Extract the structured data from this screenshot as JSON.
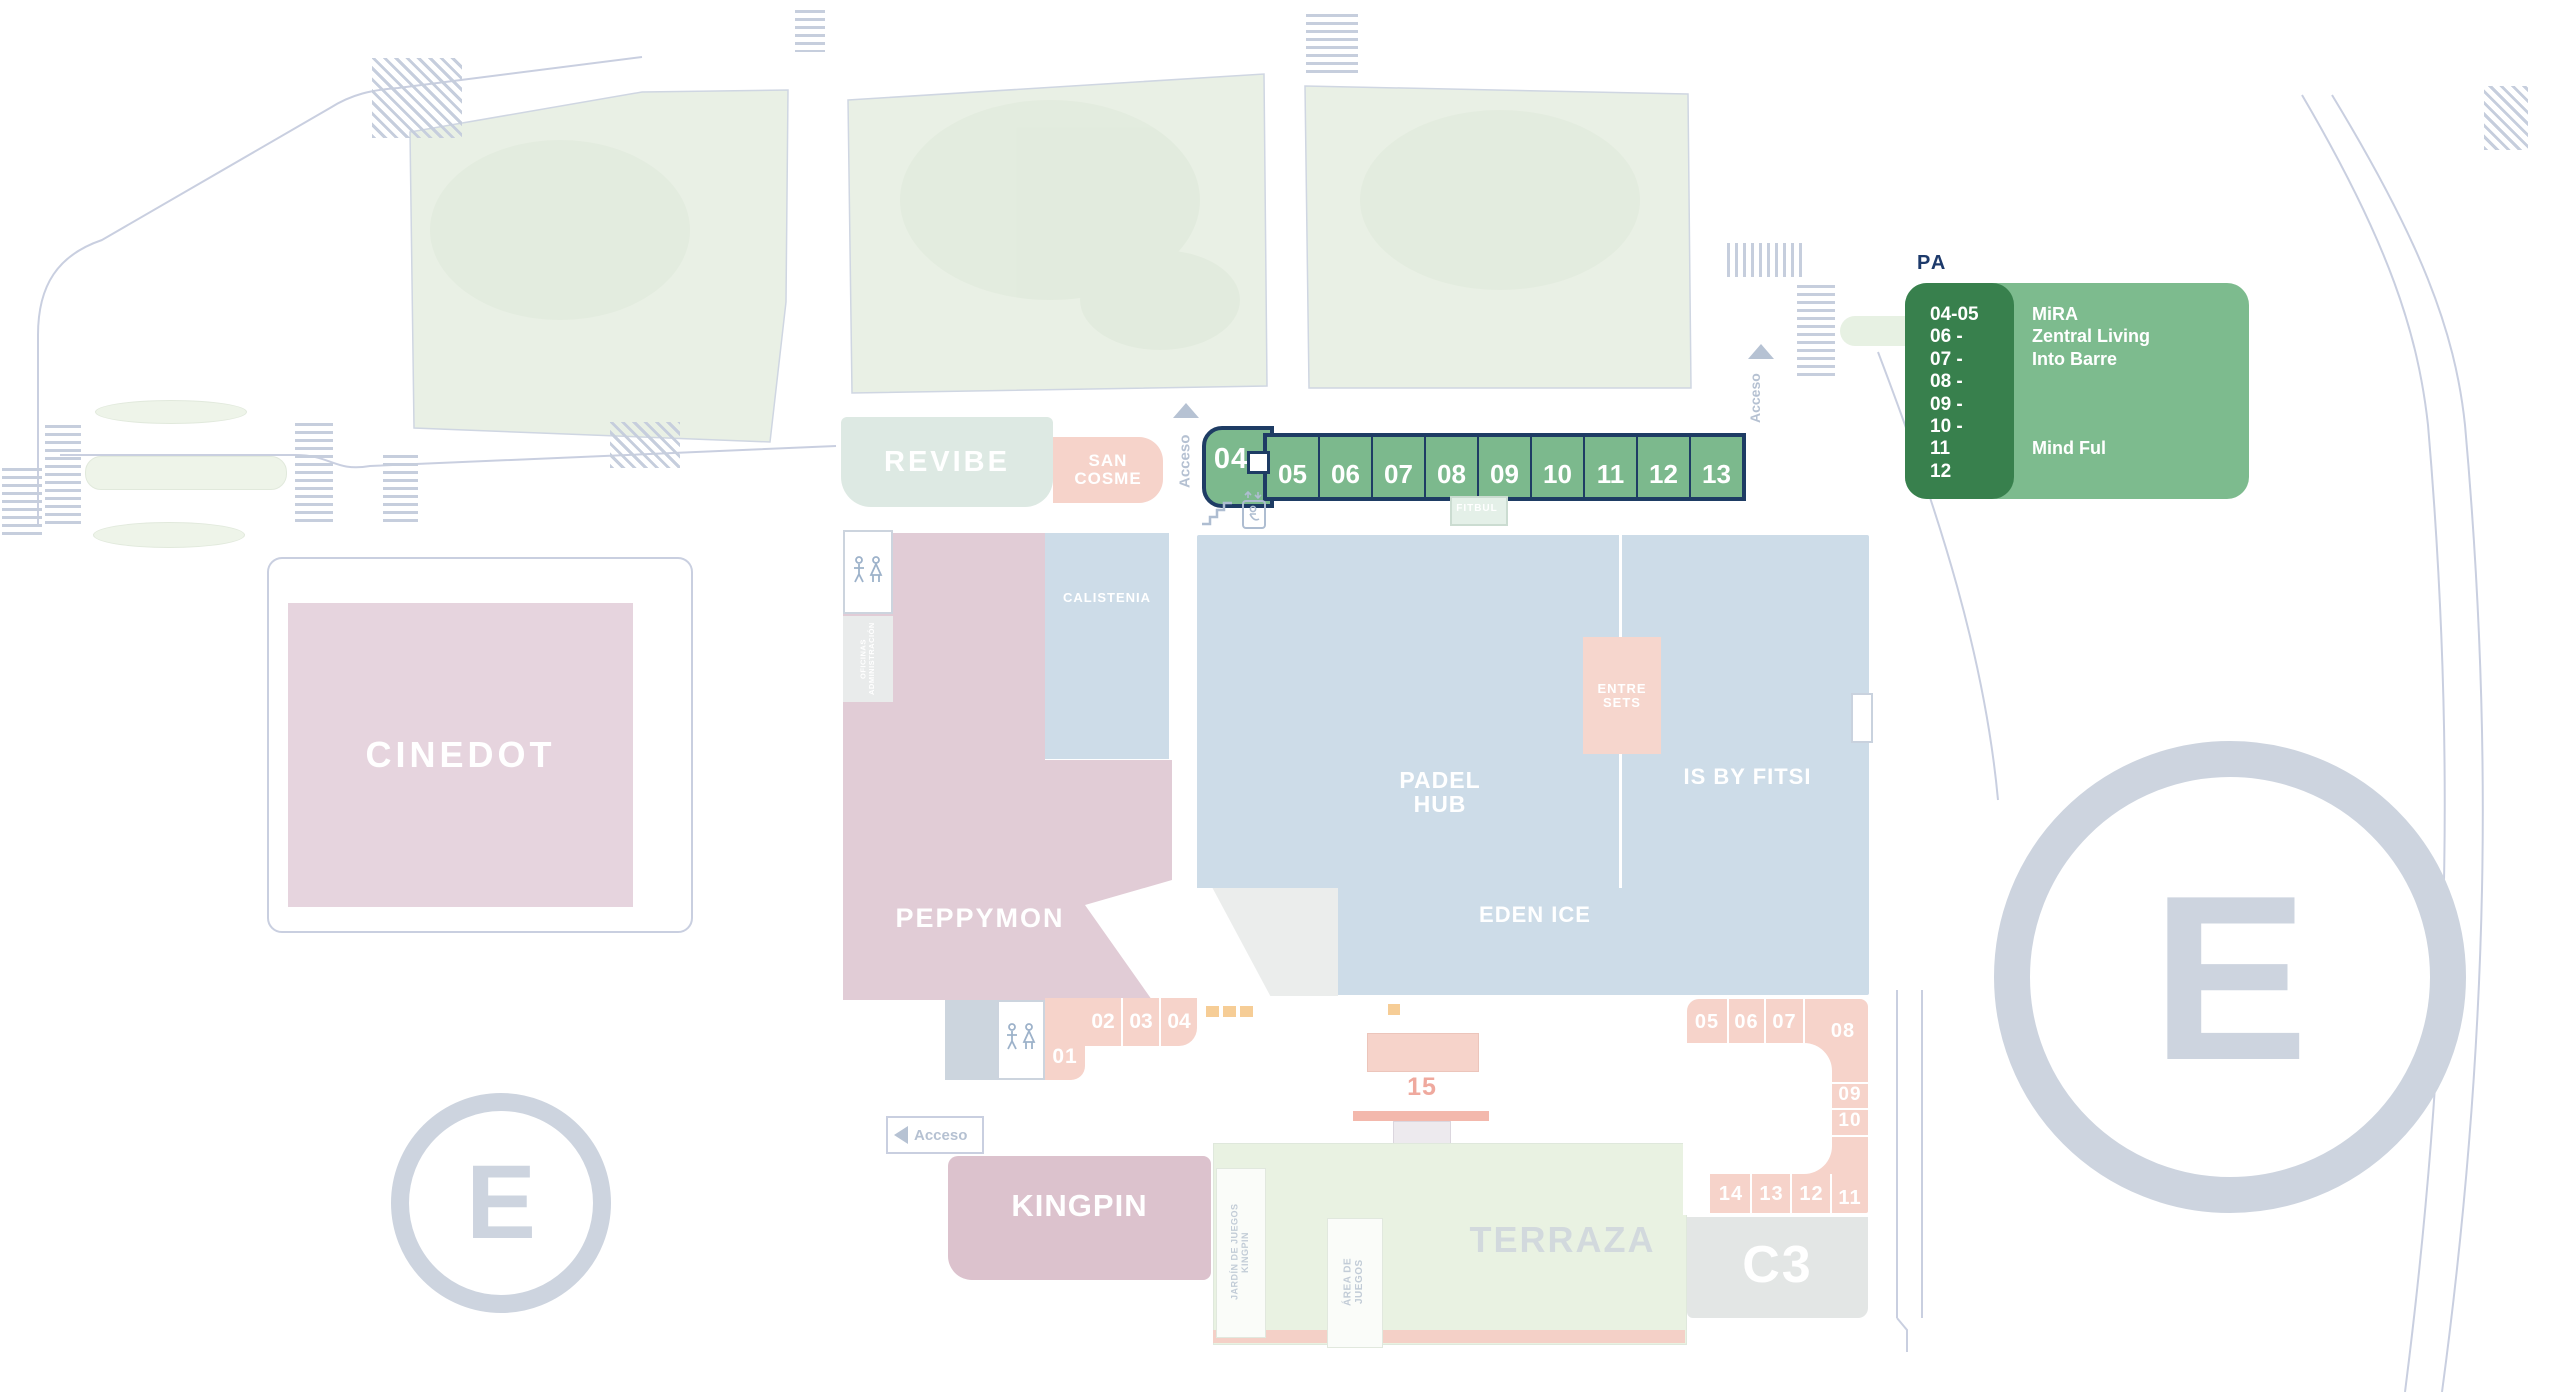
{
  "legend": {
    "pa_label": "PA",
    "rows": [
      {
        "num": "04-05",
        "name": "MiRA"
      },
      {
        "num": "06 -",
        "name": "Zentral Living"
      },
      {
        "num": "07 -",
        "name": "Into Barre"
      },
      {
        "num": "08 -",
        "name": ""
      },
      {
        "num": "09 -",
        "name": ""
      },
      {
        "num": "10 -",
        "name": ""
      },
      {
        "num": "11",
        "name": "Mind Ful"
      },
      {
        "num": "12",
        "name": ""
      }
    ]
  },
  "green_row": {
    "units": [
      "04",
      "05",
      "06",
      "07",
      "08",
      "09",
      "10",
      "11",
      "12",
      "13"
    ]
  },
  "stores": {
    "revibe": "REVIBE",
    "san_cosme": "SAN\nCOSME",
    "calistenia": "CALISTENIA",
    "padel_hub": "PADEL\nHUB",
    "is_by_fitsi": "IS BY FITSI",
    "entre_sets": "ENTRE\nSETS",
    "eden_ice": "EDEN ICE",
    "peppymon": "PEPPYMON",
    "cinedot": "CINEDOT",
    "kingpin": "KINGPIN",
    "terraza": "TERRAZA",
    "c3": "C3",
    "fitbul": "FITBUL"
  },
  "facilities": {
    "oficinas": "OFICINAS\nADMINISTRACIÓN",
    "jardin": "JARDÍN DE JUEGOS\nKINGPIN",
    "area_juegos": "ÁREA DE\nJUEGOS"
  },
  "labels": {
    "acceso": "Acceso",
    "parking": "E",
    "unit15": "15"
  },
  "units_top": [
    "01",
    "02",
    "03",
    "04"
  ],
  "units_right": {
    "top": [
      "05",
      "06",
      "07"
    ],
    "corner": "08",
    "side": [
      "09",
      "10"
    ],
    "bottom": [
      "14",
      "13",
      "12"
    ],
    "corner2": "11"
  },
  "colors": {
    "navy": "#1e3c64",
    "unit_green": "#7cb98d",
    "legend_dark": "#38804d",
    "legend_light": "#7dbb8e",
    "pink": "#f6d3ca",
    "blue": "#cddce8",
    "grey_e": "#cdd4df"
  }
}
